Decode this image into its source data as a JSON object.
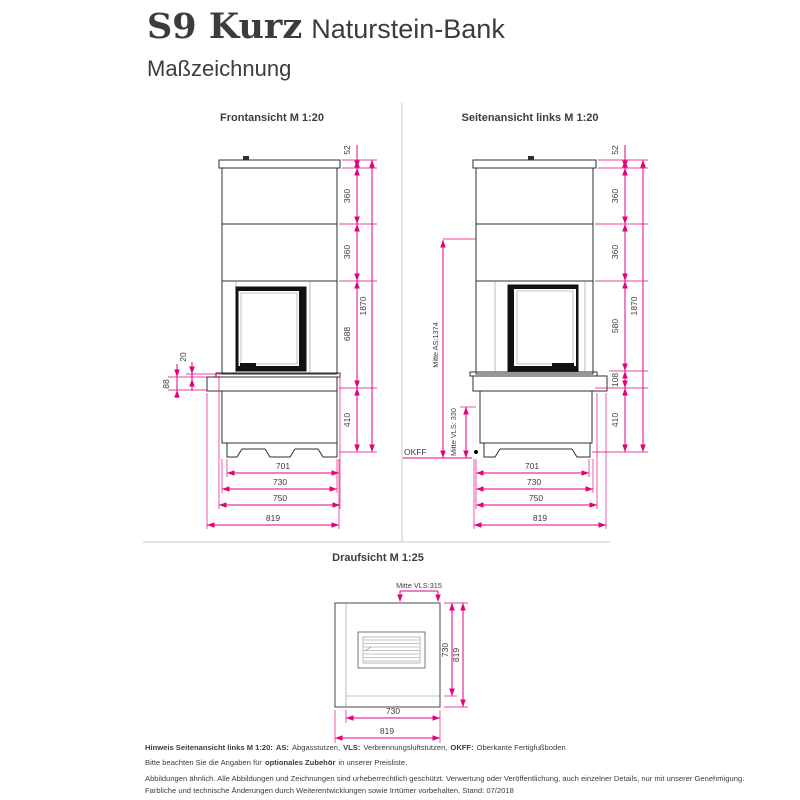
{
  "header": {
    "product": "S9 Kurz",
    "variant": "Naturstein-Bank",
    "doc_type": "Maßzeichnung"
  },
  "views": {
    "front": {
      "label": "Frontansicht M 1:20",
      "dims": {
        "right": [
          "52",
          "360",
          "360",
          "688",
          "410"
        ],
        "overall": "1870",
        "left": [
          "20",
          "88"
        ],
        "bottom": [
          "701",
          "730",
          "750",
          "819"
        ]
      }
    },
    "side": {
      "label": "Seitenansicht links M 1:20",
      "dims": {
        "right": [
          "52",
          "360",
          "360",
          "580",
          "108",
          "410"
        ],
        "overall": "1870",
        "bottom": [
          "701",
          "730",
          "750",
          "819"
        ]
      },
      "annotations": {
        "flue_center": "Mitte AS:1374",
        "air_center": "Mitte VLS: 330",
        "floor_level": "OKFF"
      }
    },
    "top": {
      "label": "Draufsicht M 1:25",
      "dims": {
        "top": "Mitte VLS:315",
        "right": [
          "730",
          "819"
        ],
        "bottom": [
          "730",
          "819"
        ]
      }
    }
  },
  "footer": {
    "line1": {
      "b1": "Hinweis Seitenansicht links M 1:20:",
      "b2": "AS:",
      "t2": "Abgasstutzen,",
      "b3": "VLS:",
      "t3": "Verbrennungsluftstutzen,",
      "b4": "OKFF:",
      "t4": "Oberkante Fertigfußboden"
    },
    "line2": {
      "t1": "Bitte beachten Sie die Angaben für",
      "b": "optionales Zubehör",
      "t2": "in unserer Preisliste."
    },
    "line3": "Abbildungen ähnlich. Alle Abbildungen und Zeichnungen sind urheberrechtlich geschützt. Verwertung oder Veröffentlichung, auch einzelner Details, nur mit unserer Genehmigung.",
    "line4": "Farbliche und technische Änderungen durch Weiterentwicklungen sowie Irrtümer vorbehalten. Stand: 07/2018"
  },
  "colors": {
    "dimension": "#e6007e",
    "ink": "#3c3c3b"
  }
}
